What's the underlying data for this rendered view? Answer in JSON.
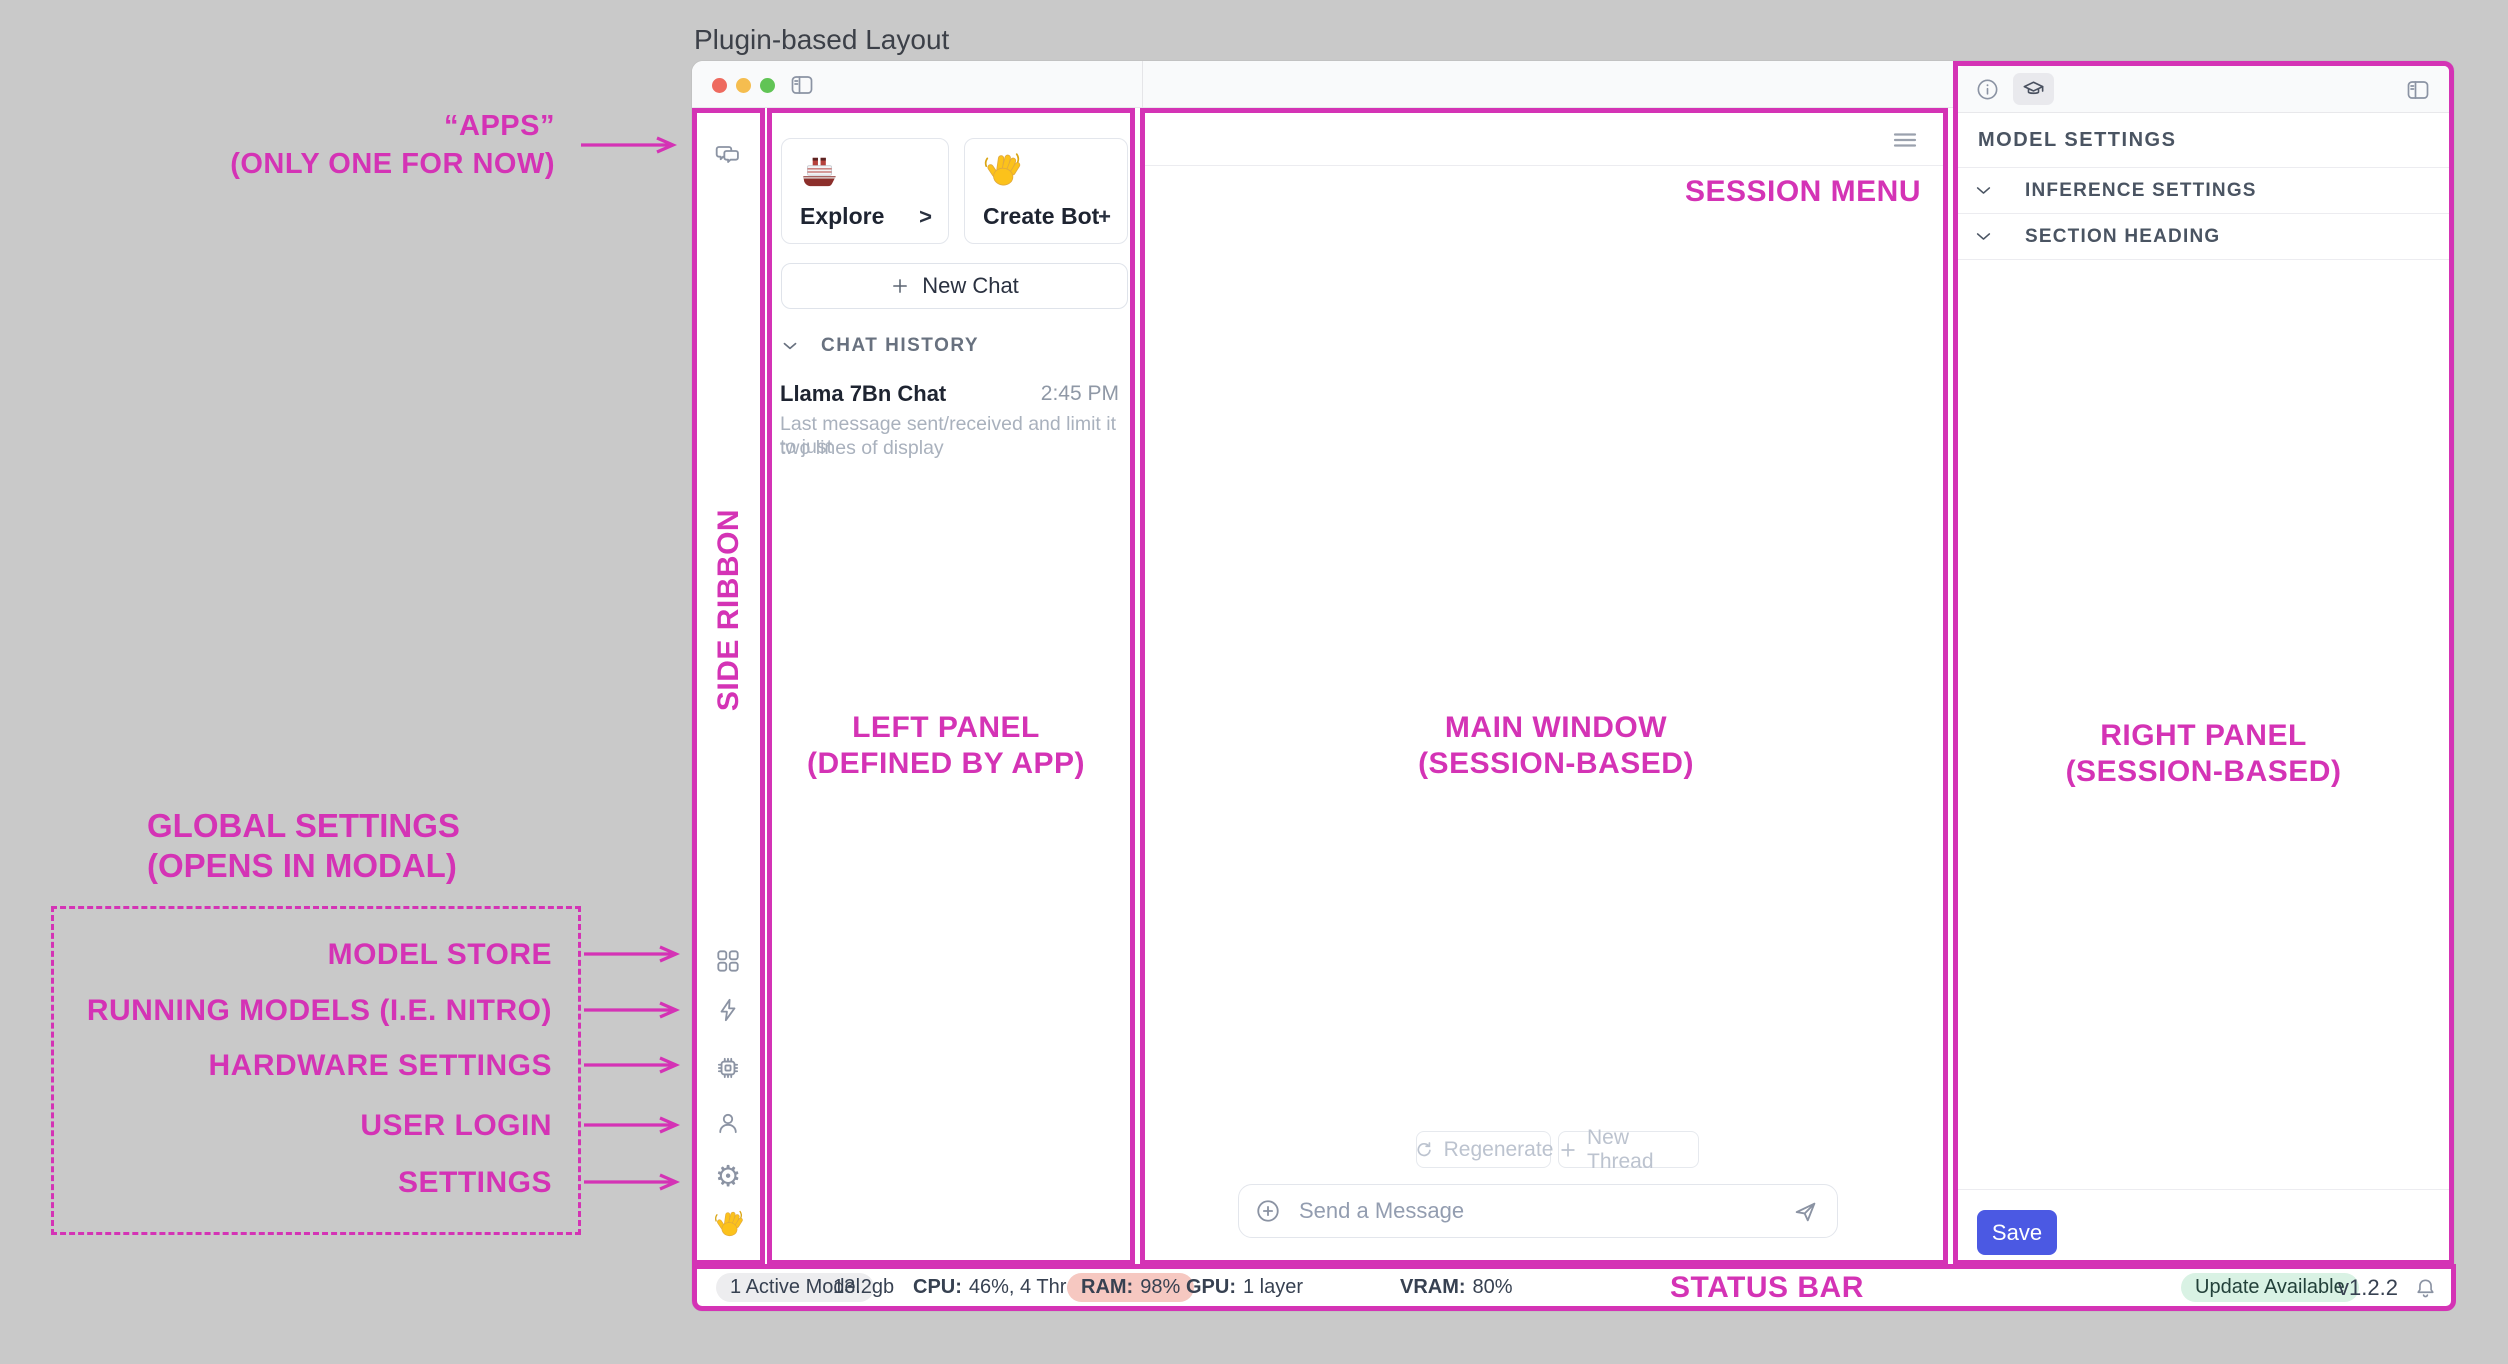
{
  "title": "Plugin-based Layout",
  "colors": {
    "annotation_pink": "#d433b5",
    "save_blue": "#4b59e3",
    "ram_pill_bg": "#f6c8c1",
    "update_pill_bg": "#d9f2e4",
    "active_model_pill_bg": "#ededef",
    "traffic_red": "#ee6a5f",
    "traffic_yellow": "#f5bd4f",
    "traffic_green": "#61c455"
  },
  "annotations": {
    "apps_line1": "“APPS”",
    "apps_line2": "(ONLY ONE FOR NOW)",
    "side_ribbon": "SIDE RIBBON",
    "left_panel_line1": "LEFT PANEL",
    "left_panel_line2": "(DEFINED BY APP)",
    "main_window_line1": "MAIN WINDOW",
    "main_window_line2": "(SESSION-BASED)",
    "right_panel_line1": "RIGHT PANEL",
    "right_panel_line2": "(SESSION-BASED)",
    "session_menu": "SESSION MENU",
    "status_bar": "STATUS BAR",
    "global_line1": "GLOBAL SETTINGS",
    "global_line2": "(OPENS IN MODAL)",
    "global_items": [
      "MODEL STORE",
      "RUNNING MODELS (I.E. NITRO)",
      "HARDWARE SETTINGS",
      "USER LOGIN",
      "SETTINGS"
    ]
  },
  "ribbon": {
    "icons": [
      "messages-icon",
      "model-store-grid-icon",
      "running-models-bolt-icon",
      "hardware-chip-icon",
      "user-login-icon",
      "settings-gear-icon",
      "wave-hand-icon"
    ],
    "gear_glyph": "⚙"
  },
  "left_panel": {
    "cards": [
      {
        "icon": "ship-emoji",
        "label": "Explore",
        "action": ">"
      },
      {
        "icon": "wave-hand-emoji",
        "label": "Create Bot",
        "action": "+"
      }
    ],
    "new_chat_label": "New Chat",
    "history_header": "CHAT HISTORY",
    "history": [
      {
        "title": "Llama 7Bn Chat",
        "time": "2:45 PM",
        "preview_line1": "Last message sent/received and limit it to just",
        "preview_line2": "two lines of display"
      }
    ]
  },
  "main_window": {
    "regenerate_label": "Regenerate",
    "new_thread_label": "New Thread",
    "message_placeholder": "Send a Message"
  },
  "right_panel": {
    "header": "MODEL SETTINGS",
    "sections": [
      "INFERENCE SETTINGS",
      "SECTION HEADING"
    ],
    "save_label": "Save"
  },
  "status_bar": {
    "active_model": "1 Active Model",
    "memory": "13.2gb",
    "cpu_label": "CPU:",
    "cpu_value": "46%, 4 Threads",
    "ram_label": "RAM:",
    "ram_value": "98%",
    "gpu_label": "GPU:",
    "gpu_value": "1 layer",
    "vram_label": "VRAM:",
    "vram_value": "80%",
    "update_badge": "Update Available",
    "version": "v1.2.2"
  }
}
